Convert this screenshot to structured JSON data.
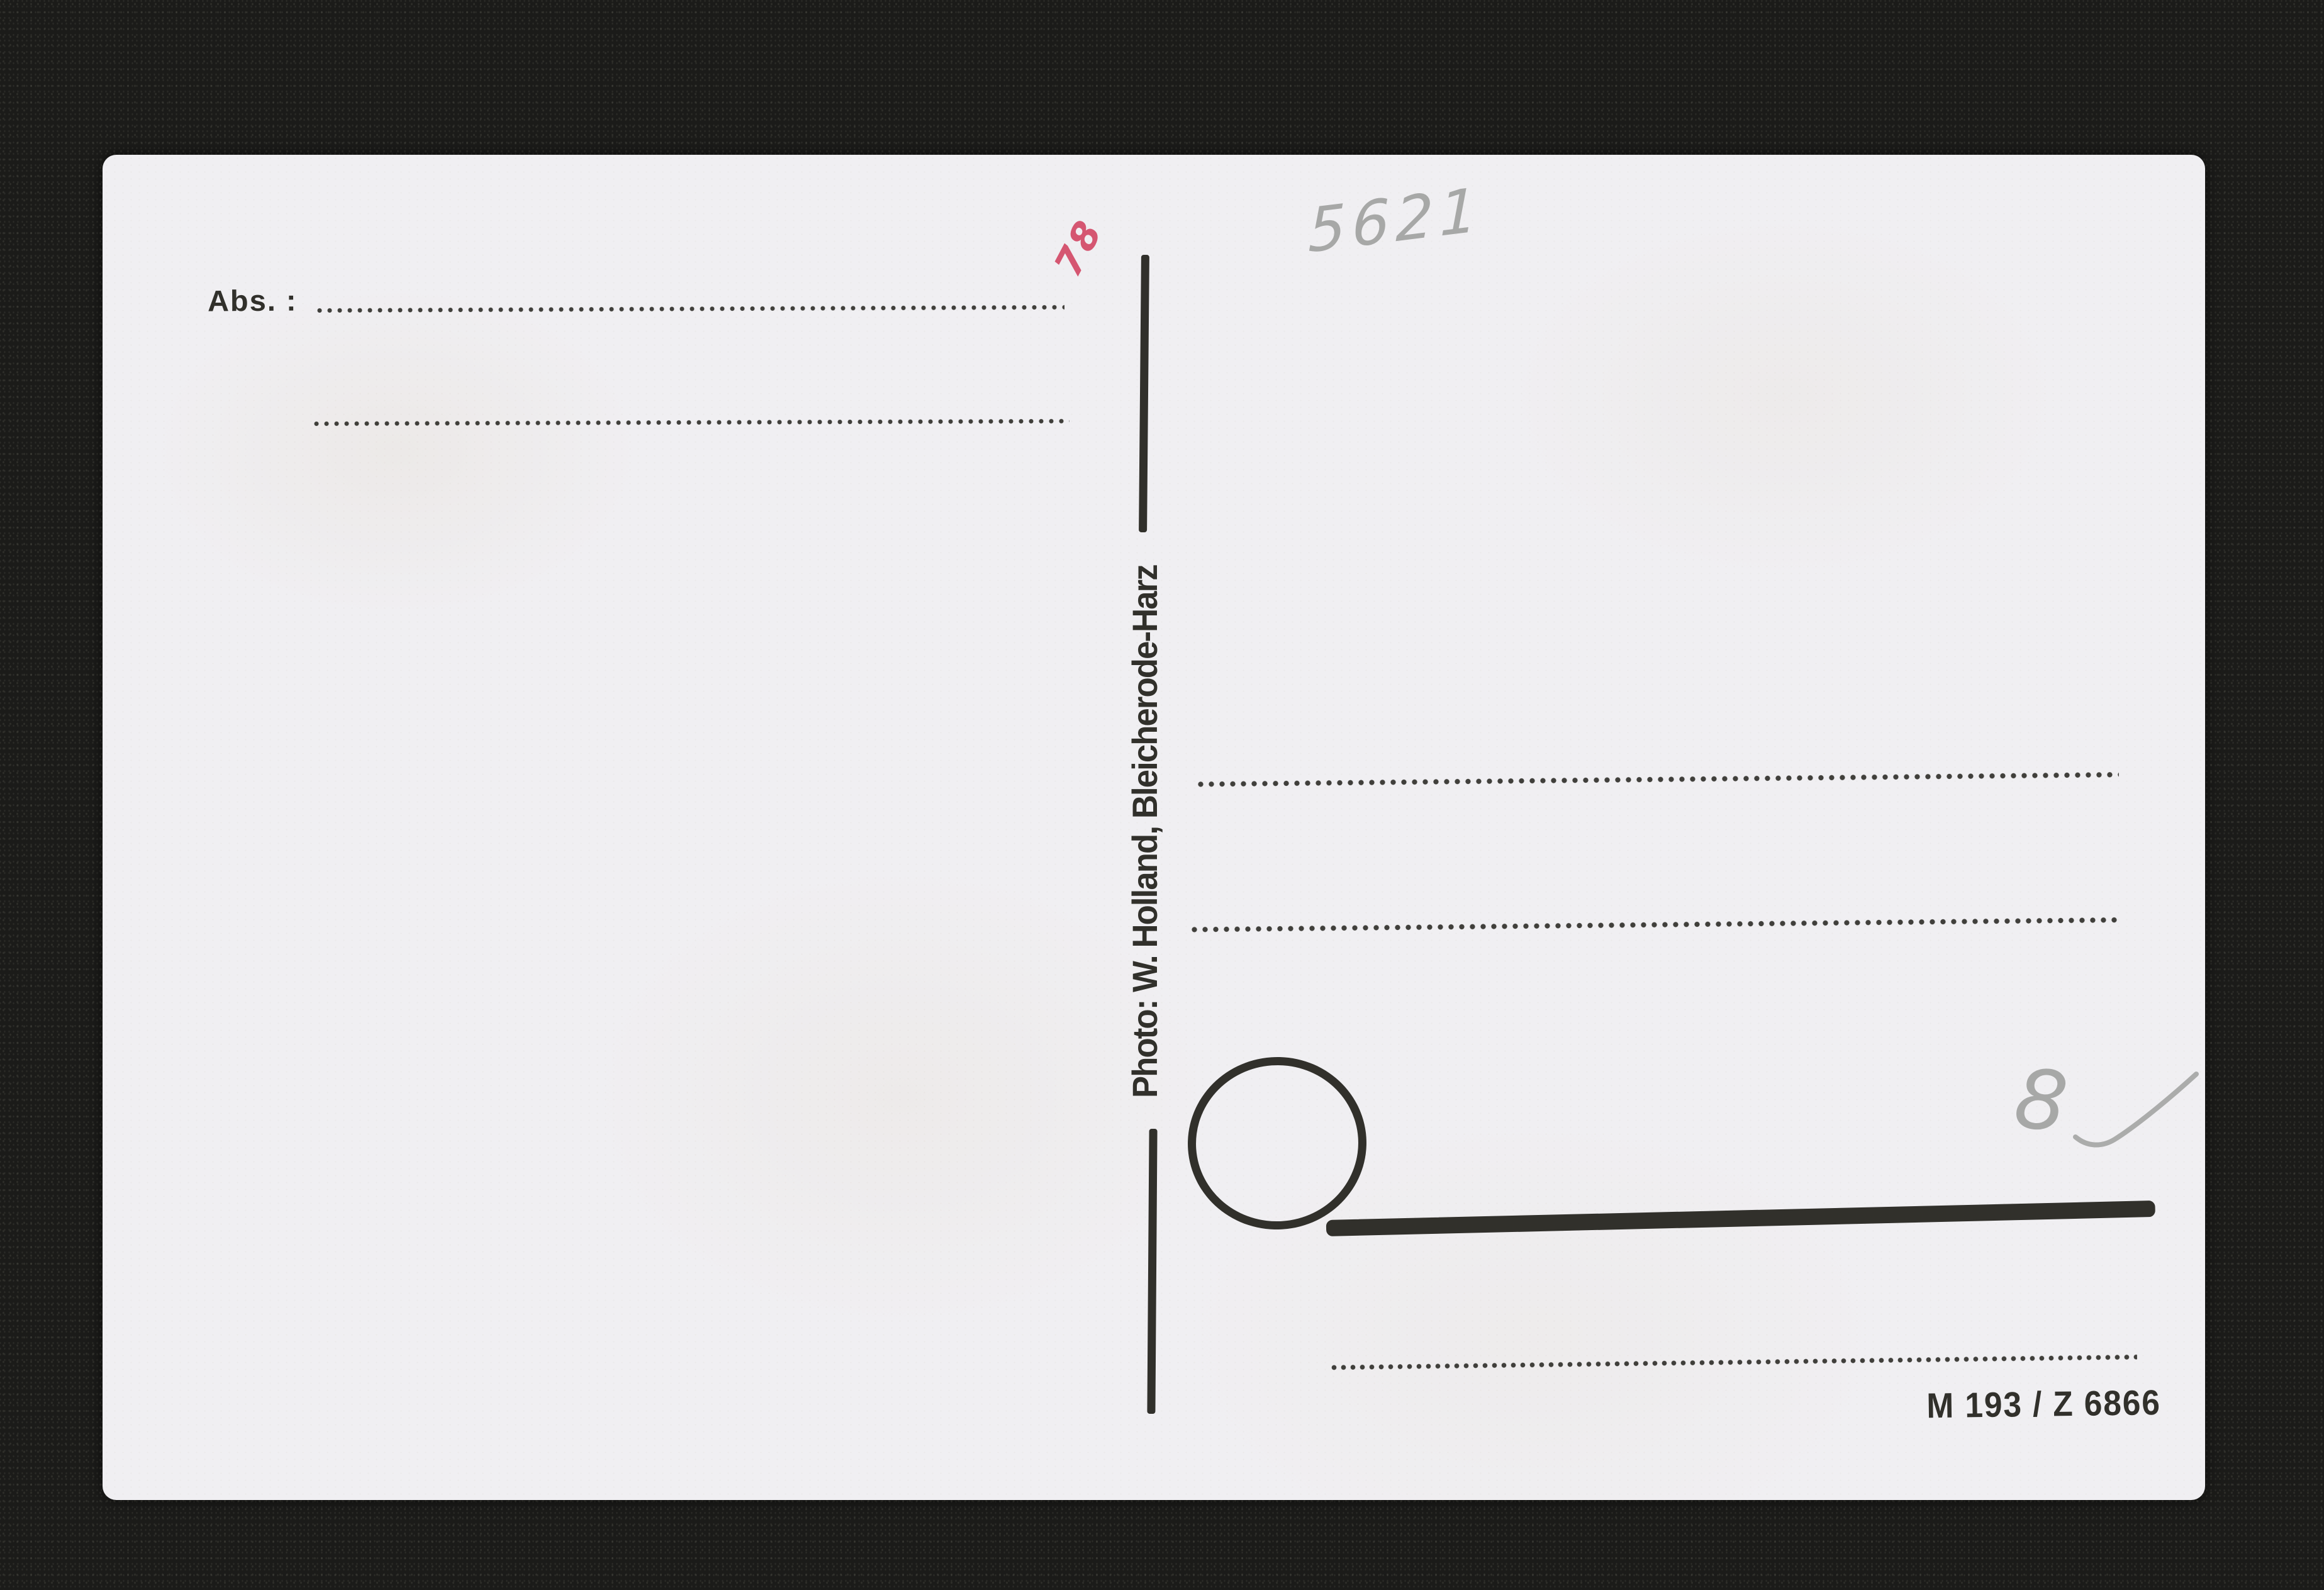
{
  "postcard": {
    "sender_label": "Abs. :",
    "photographer_credit": "Photo: W. Holland, Bleicherode-Harz",
    "print_code": "M 193 / Z 6866",
    "annotations": {
      "pencil_number": "5621",
      "red_mark": "78",
      "pencil_price": "8"
    },
    "colors": {
      "paper": "#f0eff2",
      "ink": "#31302b",
      "background": "#1b1b19",
      "pencil": "#9b9c9a",
      "red_ink": "#d34a67"
    }
  }
}
